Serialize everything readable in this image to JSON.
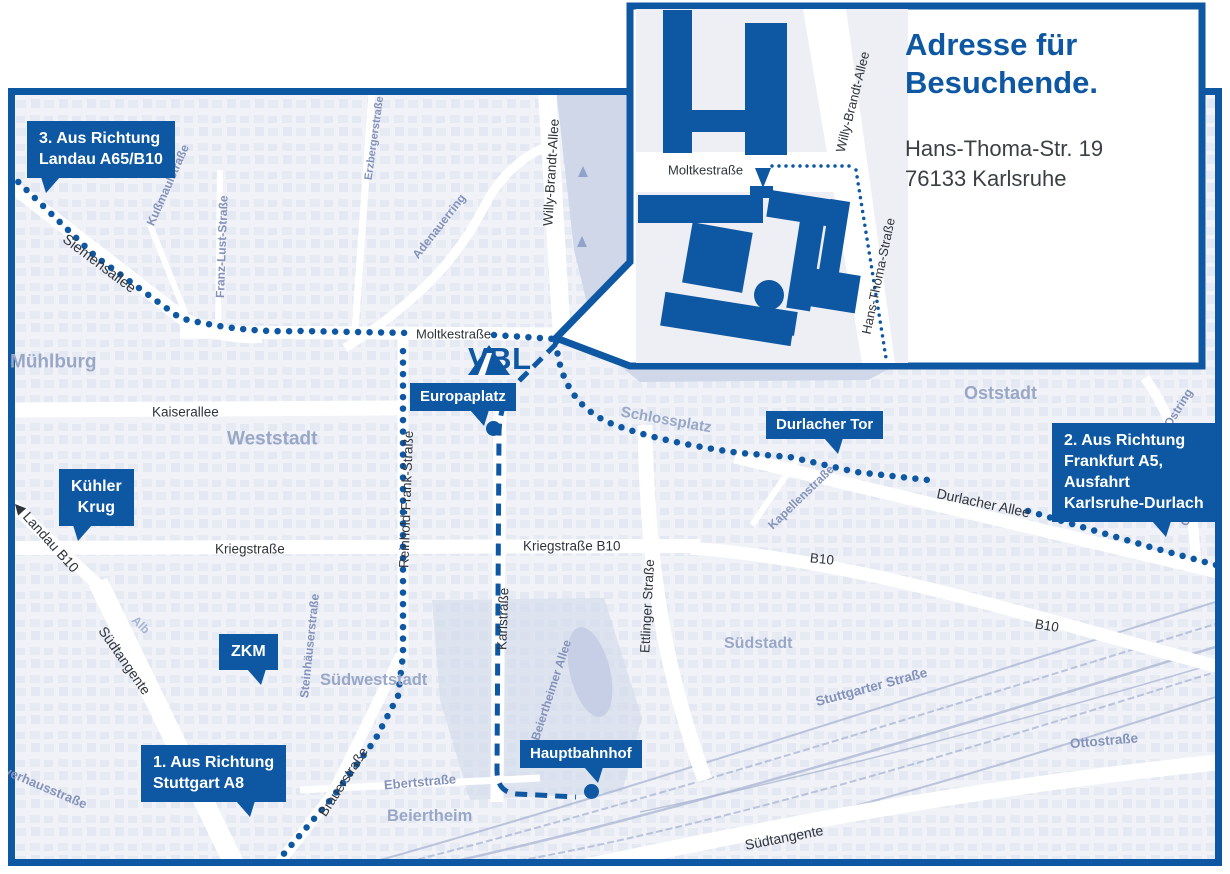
{
  "colors": {
    "brand": "#0d57a3",
    "map_bg": "#f0f2f8",
    "block": "#dde3ef",
    "block2": "#d6dcec",
    "park": "#cfd7e9",
    "rail": "#a9b4d2",
    "area_label": "#99a7c7",
    "minor_label": "#8492ba",
    "street_label": "#2f343b"
  },
  "logo": {
    "text": "VBL"
  },
  "inset": {
    "heading": [
      "Adresse für",
      "Besuchende."
    ],
    "address": [
      "Hans-Thoma-Str. 19",
      "76133 Karlsruhe"
    ],
    "labels": [
      {
        "text": "Moltkestraße",
        "x": 668,
        "y": 170,
        "rot": 0,
        "cls": "st",
        "size": 13
      },
      {
        "text": "Willy-Brandt-Allee",
        "x": 840,
        "y": 152,
        "rot": -76,
        "cls": "st",
        "size": 13
      },
      {
        "text": "Hans-Thoma-Straße",
        "x": 866,
        "y": 334,
        "rot": -78,
        "cls": "st",
        "size": 13
      }
    ]
  },
  "callouts": [
    {
      "id": "landau",
      "x": 27,
      "y": 121,
      "lines": [
        "3. Aus Richtung",
        "Landau A65/B10"
      ],
      "ptr": "l",
      "pl": 14
    },
    {
      "id": "kuehler-krug",
      "x": 59,
      "y": 469,
      "lines": [
        "Kühler",
        "Krug"
      ],
      "center": true,
      "ptr": "l",
      "pl": 14
    },
    {
      "id": "zkm",
      "x": 219,
      "y": 634,
      "lines": [
        "ZKM"
      ],
      "ptr": "r",
      "pl": 28
    },
    {
      "id": "stuttgart",
      "x": 141,
      "y": 745,
      "lines": [
        "1. Aus Richtung",
        "Stuttgart A8"
      ],
      "ptr": "r",
      "pl": 95
    },
    {
      "id": "europaplatz",
      "x": 410,
      "y": 383,
      "lines": [
        "Europaplatz"
      ],
      "small": true,
      "ptr": "r",
      "pl": 60,
      "dot": {
        "x": 493,
        "y": 428
      }
    },
    {
      "id": "durlacher-tor",
      "x": 766,
      "y": 411,
      "lines": [
        "Durlacher Tor"
      ],
      "small": true,
      "ptr": "r",
      "pl": 58
    },
    {
      "id": "frankfurt",
      "x": 1052,
      "y": 423,
      "lines": [
        "2. Aus Richtung",
        "Frankfurt A5,",
        "Ausfahrt",
        "Karlsruhe-Durlach"
      ],
      "ptr": "r",
      "pl": 100
    },
    {
      "id": "hauptbahnhof",
      "x": 520,
      "y": 740,
      "lines": [
        "Hauptbahnhof"
      ],
      "small": true,
      "ptr": "r",
      "pl": 64,
      "dot": {
        "x": 591,
        "y": 791
      }
    }
  ],
  "map_labels": [
    {
      "text": "Siemensallee",
      "x": 64,
      "y": 238,
      "rot": 37,
      "cls": "st",
      "size": 14.5
    },
    {
      "text": "Kußmaulstraße",
      "x": 150,
      "y": 225,
      "rot": -66,
      "cls": "mn"
    },
    {
      "text": "Franz-Lust-Straße",
      "x": 220,
      "y": 298,
      "rot": -88,
      "cls": "mn"
    },
    {
      "text": "Erzbergerstraße",
      "x": 369,
      "y": 180,
      "rot": -82,
      "cls": "mn",
      "size": 11
    },
    {
      "text": "Adenauerring",
      "x": 415,
      "y": 257,
      "rot": -52,
      "cls": "mn"
    },
    {
      "text": "Willy-Brandt-Allee",
      "x": 548,
      "y": 226,
      "rot": -86.5,
      "cls": "st"
    },
    {
      "text": "Moltkestraße",
      "x": 416,
      "y": 334,
      "rot": 0,
      "cls": "st",
      "size": 13
    },
    {
      "text": "Mühlburg",
      "x": 10,
      "y": 362,
      "rot": 0,
      "cls": "ar",
      "size": 19
    },
    {
      "text": "Kaiserallee",
      "x": 152,
      "y": 412,
      "rot": 0,
      "cls": "st"
    },
    {
      "text": "Weststadt",
      "x": 227,
      "y": 439,
      "rot": 0,
      "cls": "ar",
      "size": 19
    },
    {
      "text": "◀ Landau B10",
      "x": 16,
      "y": 503,
      "rot": 48,
      "cls": "st",
      "size": 14
    },
    {
      "text": "Kriegstraße",
      "x": 215,
      "y": 549,
      "rot": 0,
      "cls": "st"
    },
    {
      "text": "Kriegstraße B10",
      "x": 523,
      "y": 546,
      "rot": 0,
      "cls": "st"
    },
    {
      "text": "Reinhold-Frank-Straße",
      "x": 404,
      "y": 568,
      "rot": -88,
      "cls": "st"
    },
    {
      "text": "Karlstraße",
      "x": 502,
      "y": 650,
      "rot": -88,
      "cls": "st"
    },
    {
      "text": "Ettlinger Straße",
      "x": 645,
      "y": 653,
      "rot": -87,
      "cls": "st"
    },
    {
      "text": "Schlossplatz",
      "x": 621,
      "y": 412,
      "rot": 10,
      "cls": "ar",
      "size": 15
    },
    {
      "text": "Oststadt",
      "x": 964,
      "y": 393,
      "rot": 0,
      "cls": "ar"
    },
    {
      "text": "Durlacher Allee",
      "x": 937,
      "y": 493,
      "rot": 12,
      "cls": "st",
      "size": 14
    },
    {
      "text": "Kapellenstraße",
      "x": 770,
      "y": 527,
      "rot": -44,
      "cls": "mn"
    },
    {
      "text": "B10",
      "x": 810,
      "y": 558,
      "rot": 6,
      "cls": "st"
    },
    {
      "text": "Ostring",
      "x": 1167,
      "y": 426,
      "rot": -58,
      "cls": "mn"
    },
    {
      "text": "Ostring",
      "x": 1183,
      "y": 525,
      "rot": -58,
      "cls": "mn"
    },
    {
      "text": "B10",
      "x": 1035,
      "y": 624,
      "rot": 9,
      "cls": "st"
    },
    {
      "text": "Stuttgarter Straße",
      "x": 816,
      "y": 702,
      "rot": -15,
      "cls": "mn",
      "size": 13.5
    },
    {
      "text": "Ottostraße",
      "x": 1070,
      "y": 744,
      "rot": -5,
      "cls": "mn",
      "size": 13.5
    },
    {
      "text": "Südstadt",
      "x": 724,
      "y": 644,
      "rot": 0,
      "cls": "ar",
      "size": 16
    },
    {
      "text": "Südtangente",
      "x": 745,
      "y": 845,
      "rot": -11,
      "cls": "st",
      "size": 14
    },
    {
      "text": "Südtangente",
      "x": 102,
      "y": 628,
      "rot": 55,
      "cls": "st",
      "size": 14
    },
    {
      "text": "Alb",
      "x": 134,
      "y": 618,
      "rot": 45,
      "cls": "wt"
    },
    {
      "text": "Steinhäuserstraße",
      "x": 304,
      "y": 698,
      "rot": -84,
      "cls": "mn"
    },
    {
      "text": "Südweststadt",
      "x": 320,
      "y": 680,
      "rot": 0,
      "cls": "ar",
      "size": 16.5
    },
    {
      "text": "Brauerstraße",
      "x": 322,
      "y": 815,
      "rot": -57,
      "cls": "st"
    },
    {
      "text": "Ebertstraße",
      "x": 384,
      "y": 785,
      "rot": -5,
      "cls": "mn",
      "size": 13
    },
    {
      "text": "Beiertheim",
      "x": 387,
      "y": 816,
      "rot": 0,
      "cls": "ar",
      "size": 16.5
    },
    {
      "text": "Beiertheimer Allee",
      "x": 535,
      "y": 740,
      "rot": -72,
      "cls": "mn"
    },
    {
      "text": "Pulverhausstraße",
      "x": -14,
      "y": 762,
      "rot": 23,
      "cls": "mn",
      "size": 13
    }
  ]
}
